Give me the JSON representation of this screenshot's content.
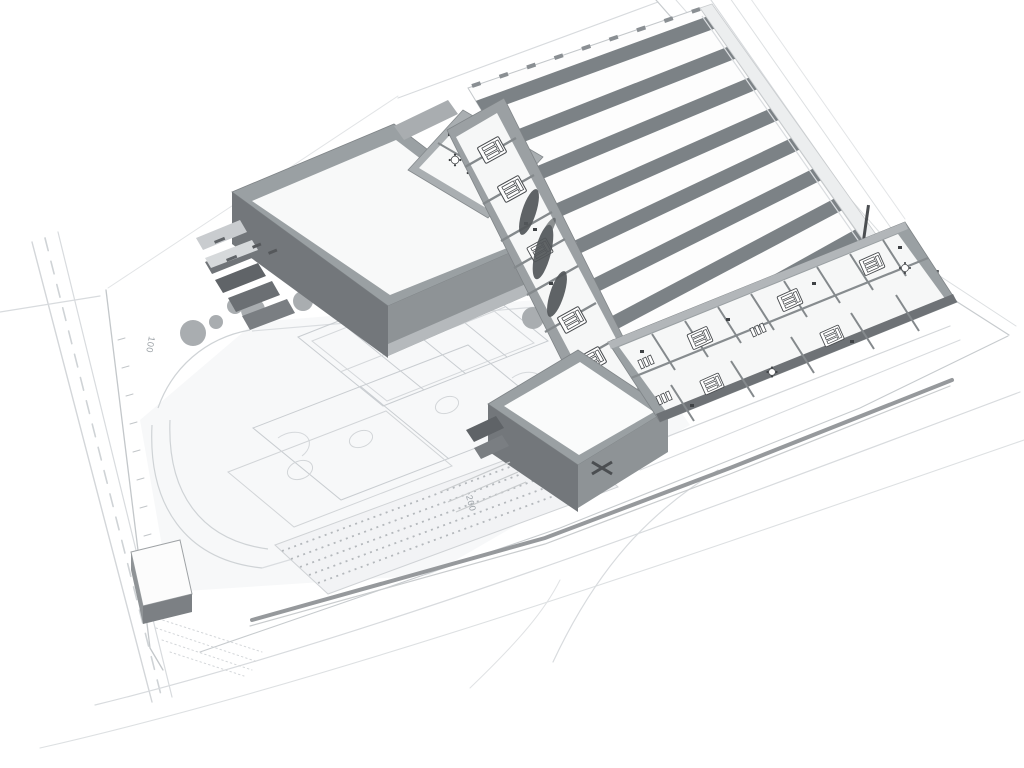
{
  "scene": {
    "kind": "architectural-3d-site-rendering",
    "style": "monochrome axonometric massing model on white background",
    "roof_ridge_count": 8,
    "classroom_desk_groups_visible": 8
  },
  "track_markers": [
    {
      "label": "050",
      "x": 421,
      "y": 281,
      "rotation": 127
    },
    {
      "label": "100",
      "x": 149,
      "y": 336,
      "rotation": 100
    },
    {
      "label": "150",
      "x": 177,
      "y": 559,
      "rotation": 185
    },
    {
      "label": "200",
      "x": 466,
      "y": 496,
      "rotation": 75
    }
  ],
  "palette": {
    "background": "#ffffff",
    "ridge_shadow": "#7c8286",
    "wall_top": "#9aa0a3",
    "wall_light": "#b2b6b9",
    "wall_mid": "#8e9396",
    "wall_dark": "#6e7276",
    "wall_darker": "#5c6063",
    "floor": "#f6f7f7",
    "site_line": "#c7cbce",
    "site_line_light": "#d8dbde",
    "ground_tint": "#f3f4f6",
    "tree_gray": "#a9adb0",
    "tree_dark": "#53575a",
    "furniture_dark": "#3f4245"
  }
}
